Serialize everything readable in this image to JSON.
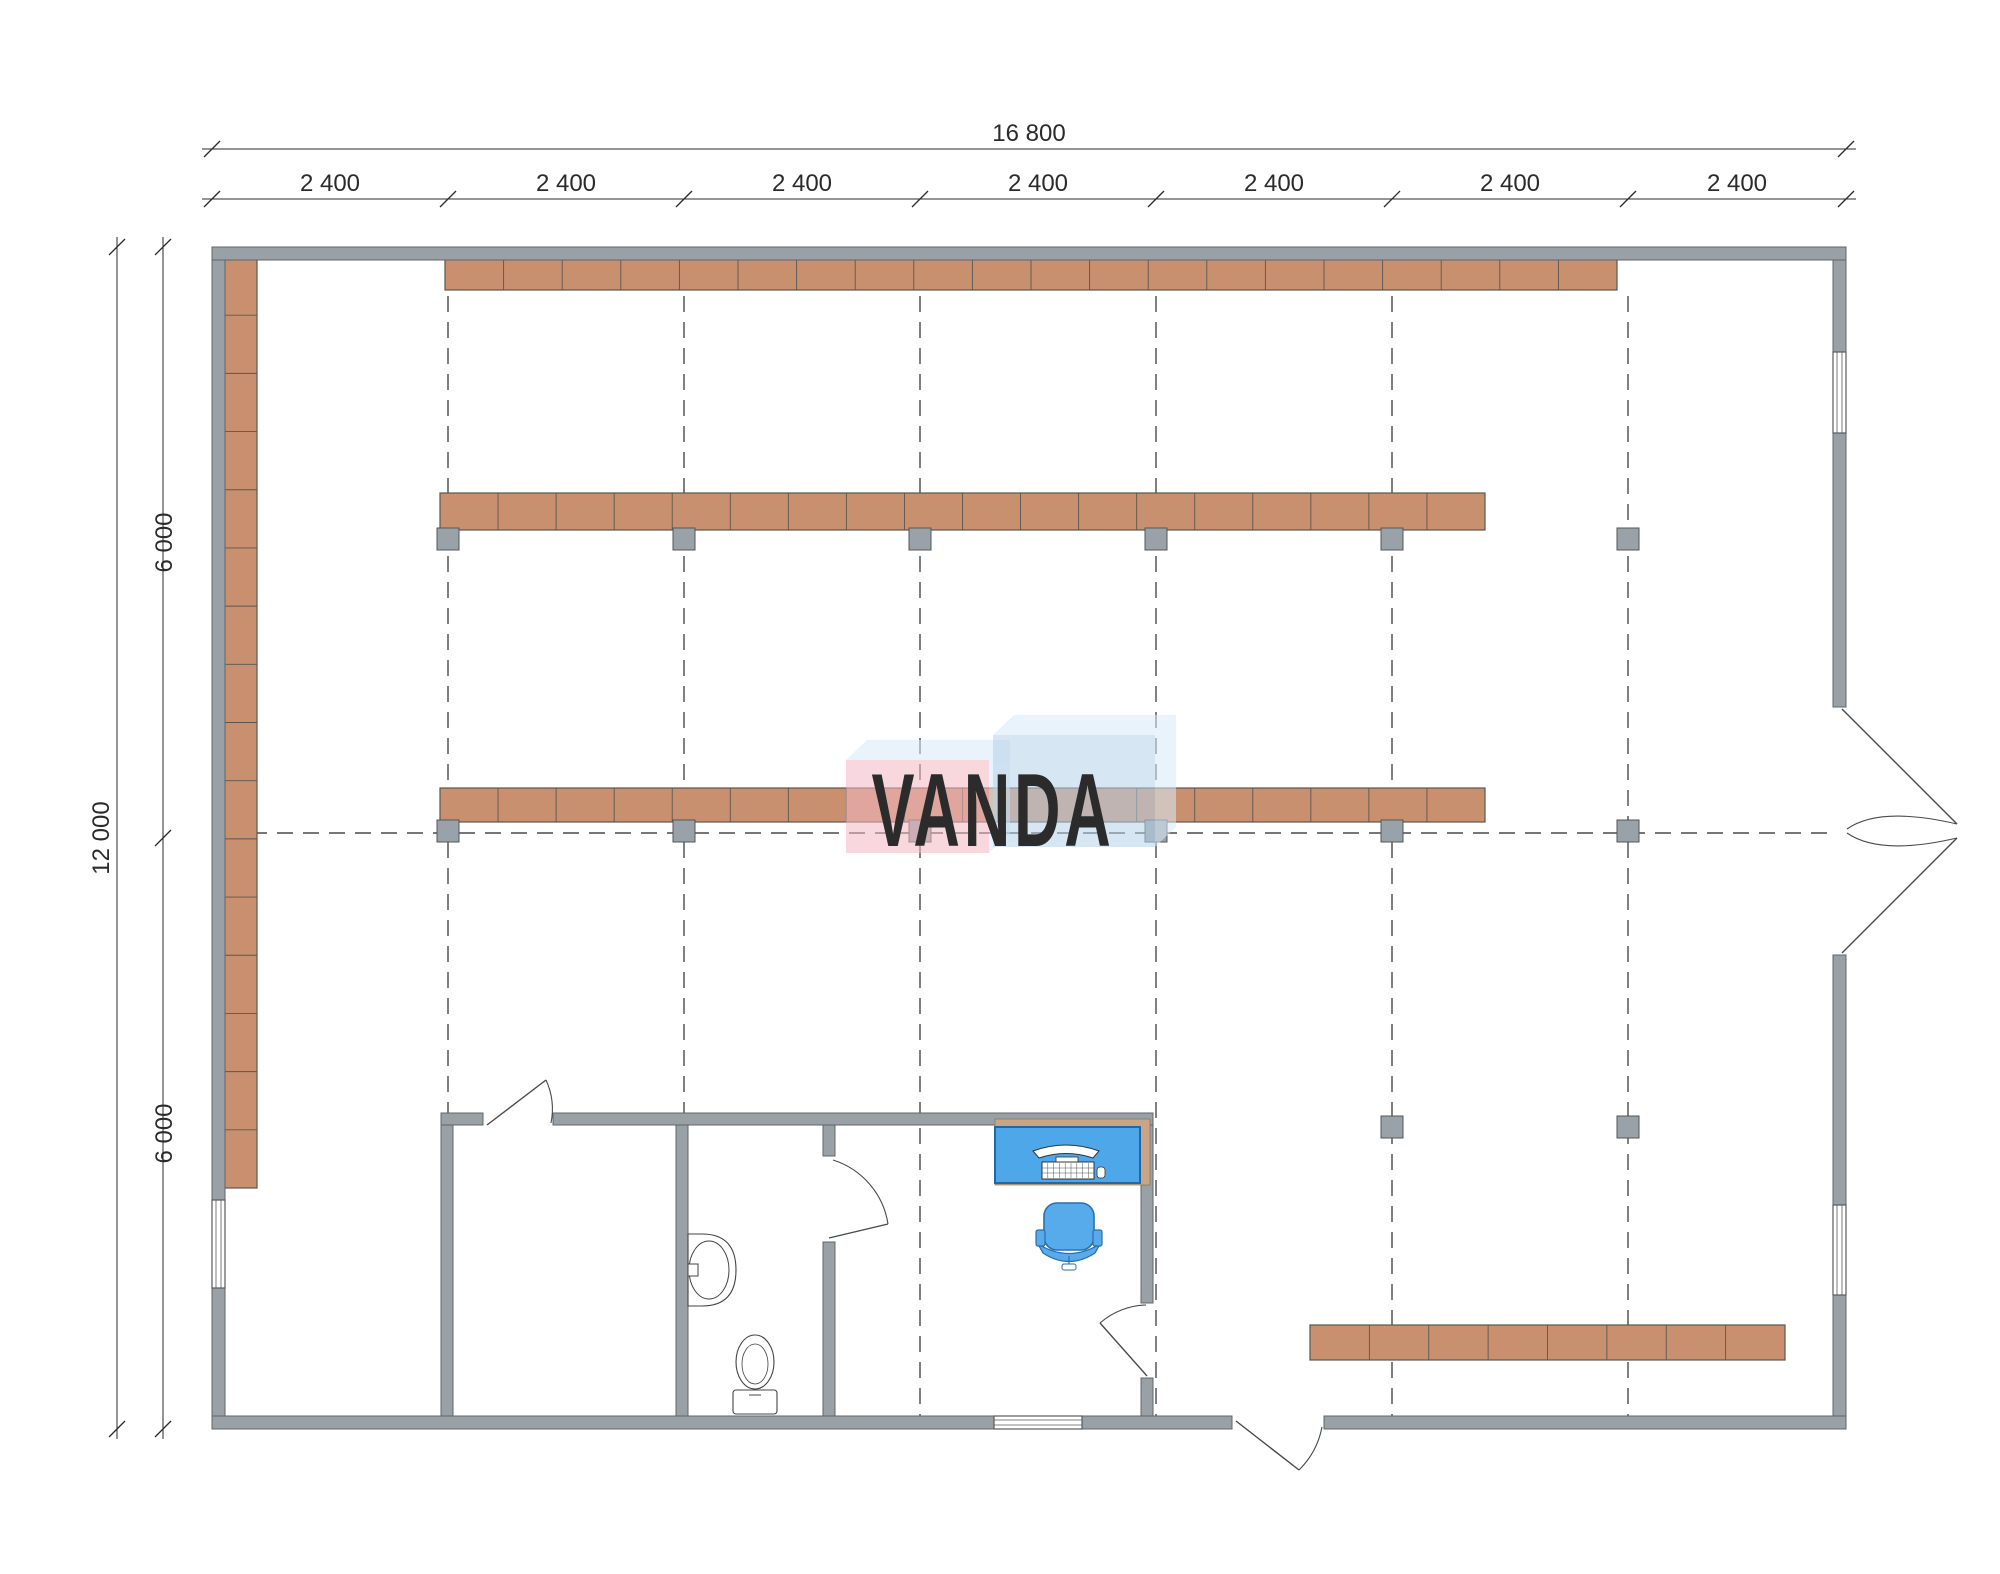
{
  "dimensions": {
    "top_total": "16 800",
    "top_segments": [
      "2 400",
      "2 400",
      "2 400",
      "2 400",
      "2 400",
      "2 400",
      "2 400"
    ],
    "left_total": "12 000",
    "left_segments": [
      "6 000",
      "6 000"
    ],
    "text_color": "#2b2b2b",
    "font_size": 24
  },
  "watermark": {
    "text": "VANDA",
    "pink_front": "#f3b8c3",
    "blue_front": "#b7d2ea",
    "top_face": "#d8ebf8",
    "box_opacity": 0.55,
    "text_color": "rgba(255,255,255,0.88)",
    "pink_box": [
      846,
      760,
      143,
      93
    ],
    "blue_box": [
      993,
      735,
      162,
      112
    ],
    "skew": [
      21,
      -20
    ]
  },
  "plan": {
    "colors": {
      "wall": "#9aa1a6",
      "wall_stroke": "#60666b",
      "shelf": "#c9906f",
      "shelf_stroke": "#5a564f",
      "post": "#99a2a8",
      "post_stroke": "#555555",
      "grid": "#4a4a4a",
      "door": "#4a4a4a",
      "desk": "#4ea7e9",
      "desk_stroke": "#2268a8",
      "desk_back": "#c9a585",
      "chair": "#58abeb",
      "chair_stroke": "#2a6fae",
      "fixture_stroke": "#444444",
      "window_stroke": "#5a5a5a"
    },
    "grid": {
      "axes_x": [
        448,
        684,
        920,
        1156,
        1392,
        1628
      ],
      "y1": 296,
      "y2": 1416,
      "mid_y": 833,
      "x1": 225,
      "x2": 1833
    },
    "ext_walls": [
      [
        212,
        247,
        1634,
        13
      ],
      [
        212,
        1416,
        1020,
        13
      ],
      [
        1324,
        1416,
        522,
        13
      ],
      [
        212,
        260,
        13,
        940
      ],
      [
        212,
        1288,
        13,
        128
      ],
      [
        1833,
        260,
        13,
        92
      ],
      [
        1833,
        433,
        13,
        274
      ],
      [
        1833,
        955,
        13,
        250
      ],
      [
        1833,
        1295,
        13,
        121
      ]
    ],
    "int_walls": [
      [
        441,
        1113,
        42,
        12
      ],
      [
        553,
        1113,
        600,
        12
      ],
      [
        441,
        1125,
        12,
        291
      ],
      [
        676,
        1125,
        12,
        291
      ],
      [
        823,
        1125,
        12,
        31
      ],
      [
        823,
        1242,
        12,
        174
      ],
      [
        1141,
        1125,
        12,
        178
      ],
      [
        1141,
        1378,
        12,
        38
      ]
    ],
    "windows": [
      {
        "x": 212,
        "y": 1200,
        "w": 13,
        "h": 88,
        "orient": "v"
      },
      {
        "x": 1833,
        "y": 352,
        "w": 13,
        "h": 81,
        "orient": "v"
      },
      {
        "x": 1833,
        "y": 1205,
        "w": 13,
        "h": 90,
        "orient": "v"
      },
      {
        "x": 994,
        "y": 1416,
        "w": 88,
        "h": 13,
        "orient": "h"
      }
    ],
    "shelf_rows": [
      {
        "x": 445,
        "y": 256,
        "w": 1172,
        "h": 34,
        "segs": 20
      },
      {
        "x": 440,
        "y": 493,
        "w": 1045,
        "h": 37,
        "segs": 18
      },
      {
        "x": 440,
        "y": 788,
        "w": 1045,
        "h": 34,
        "segs": 18
      },
      {
        "x": 1310,
        "y": 1325,
        "w": 475,
        "h": 35,
        "segs": 8
      }
    ],
    "shelf_column": {
      "x": 224,
      "y": 257,
      "w": 33,
      "h": 931,
      "segs": 16
    },
    "posts": {
      "size": 22,
      "centers": [
        [
          448,
          539
        ],
        [
          684,
          539
        ],
        [
          920,
          539
        ],
        [
          1156,
          539
        ],
        [
          1392,
          539
        ],
        [
          1628,
          539
        ],
        [
          448,
          831
        ],
        [
          684,
          831
        ],
        [
          920,
          831
        ],
        [
          1156,
          831
        ],
        [
          1392,
          831
        ],
        [
          1628,
          831
        ],
        [
          1392,
          1127
        ],
        [
          1628,
          1127
        ]
      ]
    },
    "doors": [
      {
        "name": "door-storage",
        "leaf": [
          487,
          1125,
          546,
          1080
        ],
        "arc": "M546,1080 A70,70 0 0 1 551,1123"
      },
      {
        "name": "door-toilet",
        "leaf": [
          829,
          1238,
          888,
          1224
        ],
        "arc": "M833,1160 A80,80 0 0 1 888,1224"
      },
      {
        "name": "door-office",
        "leaf": [
          1147,
          1376,
          1100,
          1323
        ],
        "arc": "M1146,1305 A73,73 0 0 0 1100,1323"
      },
      {
        "name": "door-exit-south",
        "leaf": [
          1236,
          1421,
          1299,
          1470
        ],
        "arc": "M1322,1427 A82,82 0 0 1 1299,1470"
      },
      {
        "name": "door-entrance-leaf-top",
        "leaf": [
          1842,
          709,
          1957,
          824
        ],
        "arc": "M1957,824 Q1880,806 1847,829"
      },
      {
        "name": "door-entrance-leaf-bottom",
        "leaf": [
          1842,
          953,
          1957,
          838
        ],
        "arc": "M1957,838 Q1880,856 1847,833"
      }
    ],
    "desk": {
      "back": [
        995,
        1119,
        155,
        66
      ],
      "top": [
        995,
        1127,
        145,
        56
      ]
    },
    "chair": {
      "seat": [
        1044,
        1203,
        50,
        47
      ],
      "arm_left": [
        1036,
        1230,
        9,
        16
      ],
      "arm_right": [
        1093,
        1230,
        9,
        16
      ],
      "foot": [
        1062,
        1256,
        14,
        10
      ]
    },
    "sink": {
      "wall_x": 688,
      "cx": 709,
      "cy": 1270,
      "rx": 20,
      "ry": 29,
      "body_w": 48,
      "body_h": 72
    },
    "toilet": {
      "tank": [
        733,
        1390,
        44,
        24
      ],
      "bowl_cx": 755,
      "bowl_cy": 1362,
      "bowl_rx": 19,
      "bowl_ry": 27
    },
    "dims": {
      "top": {
        "line1_y": 149,
        "line2_y": 199,
        "x1": 212,
        "x2": 1846,
        "axes": [
          212,
          448,
          684,
          920,
          1156,
          1392,
          1628,
          1846
        ]
      },
      "left": {
        "line1_x": 117,
        "line2_x": 163,
        "y1": 247,
        "y2": 1429,
        "ticks": [
          247,
          838,
          1429
        ]
      }
    }
  }
}
